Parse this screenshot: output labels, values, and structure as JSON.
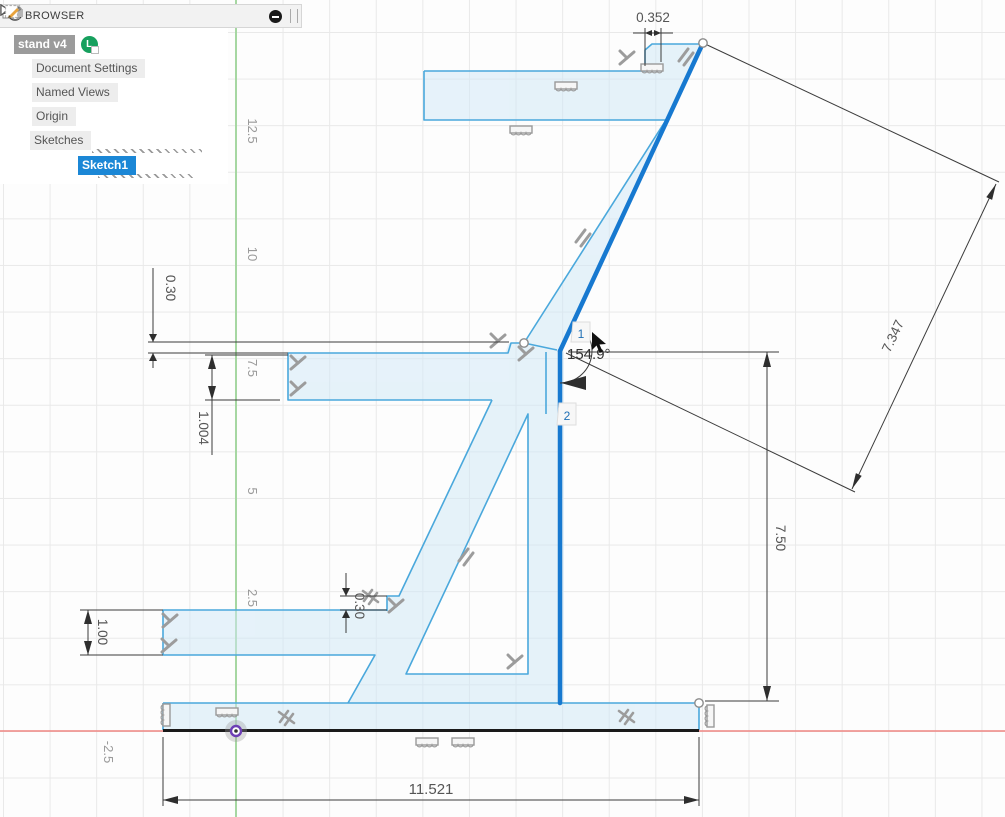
{
  "browser": {
    "title": "BROWSER",
    "items": {
      "root": "stand v4",
      "badge": "L",
      "doc_settings": "Document Settings",
      "named_views": "Named Views",
      "origin": "Origin",
      "sketches": "Sketches",
      "sketch1": "Sketch1"
    }
  },
  "sketch": {
    "dimensions": {
      "step_top": "0.352",
      "gap_upper": "0.30",
      "arm_mid_thickness": "1.004",
      "diagonal_length": "7.347",
      "angle": "154.9°",
      "column_height": "7.50",
      "step_lower": "0.30",
      "arm_lower_thickness": "1.00",
      "base_width": "11.521"
    },
    "selection_tags": {
      "first": "1",
      "second": "2"
    },
    "axis_labels": {
      "y": [
        "12.5",
        "10",
        "7.5",
        "5",
        "2.5"
      ],
      "x": [
        "-2.5"
      ]
    },
    "colors": {
      "selected_line": "#1779d0",
      "sketch_line": "#4aa8dc",
      "sketch_fill": "#cfe8f7",
      "axis_x": "#ef8581",
      "axis_y": "#a6d7a2",
      "fixed_line": "#1a1a1a",
      "origin_point": "#6d3fb5",
      "selection_bg": "#1b87d6",
      "constraint_icon": "#9c9c9c"
    },
    "icons": {
      "perpendicular-constraint-icon": "rotated T bars",
      "parallel-constraint-icon": "double slanted bars",
      "collinear-constraint-icon": "bar with scalloped hatching",
      "symmetry-constraint-icon": "slanted bars with cross slash",
      "origin-point-icon": "purple ringed dot",
      "sketch-point-icon": "small open circle"
    }
  }
}
